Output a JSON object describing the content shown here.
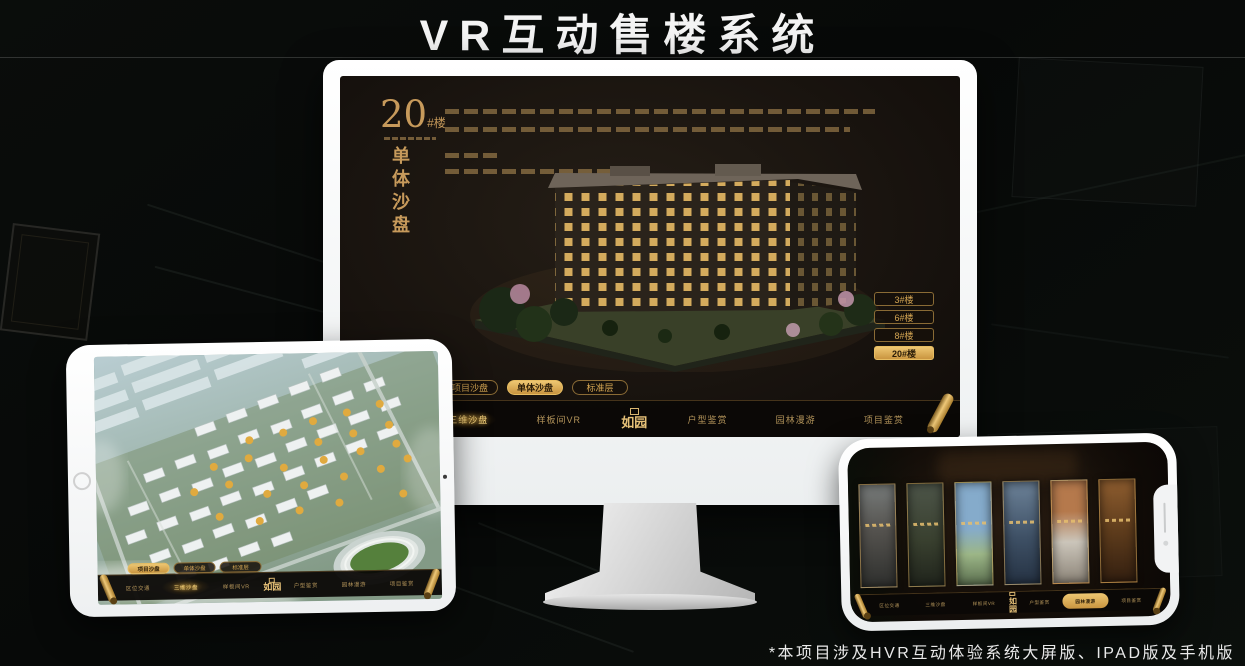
{
  "page": {
    "title": "VR互动售楼系统",
    "footnote": "*本项目涉及HVR互动体验系统大屏版、IPAD版及手机版"
  },
  "branding": {
    "logo": "如园"
  },
  "nav_items": [
    "区位交通",
    "三维沙盘",
    "样板间VR",
    "户型鉴赏",
    "园林漫游",
    "项目鉴赏"
  ],
  "tabs": [
    "项目沙盘",
    "单体沙盘",
    "标准层"
  ],
  "monitor": {
    "heading_number": "20",
    "heading_unit": "#楼",
    "heading_subtitle": "单体沙盘",
    "floor_buttons": [
      "3#楼",
      "6#楼",
      "8#楼",
      "20#楼"
    ],
    "active_floor": "20#楼",
    "active_tab": "单体沙盘",
    "active_nav": "三维沙盘"
  },
  "tablet": {
    "active_tab": "项目沙盘",
    "active_nav": "三维沙盘"
  },
  "phone": {
    "active_nav": "园林漫游",
    "gallery_panels": 6
  },
  "colors": {
    "gold": "#d2a452",
    "gold_bright": "#eec878",
    "screen_dark": "#171210",
    "device_white": "#f2f3f4"
  }
}
